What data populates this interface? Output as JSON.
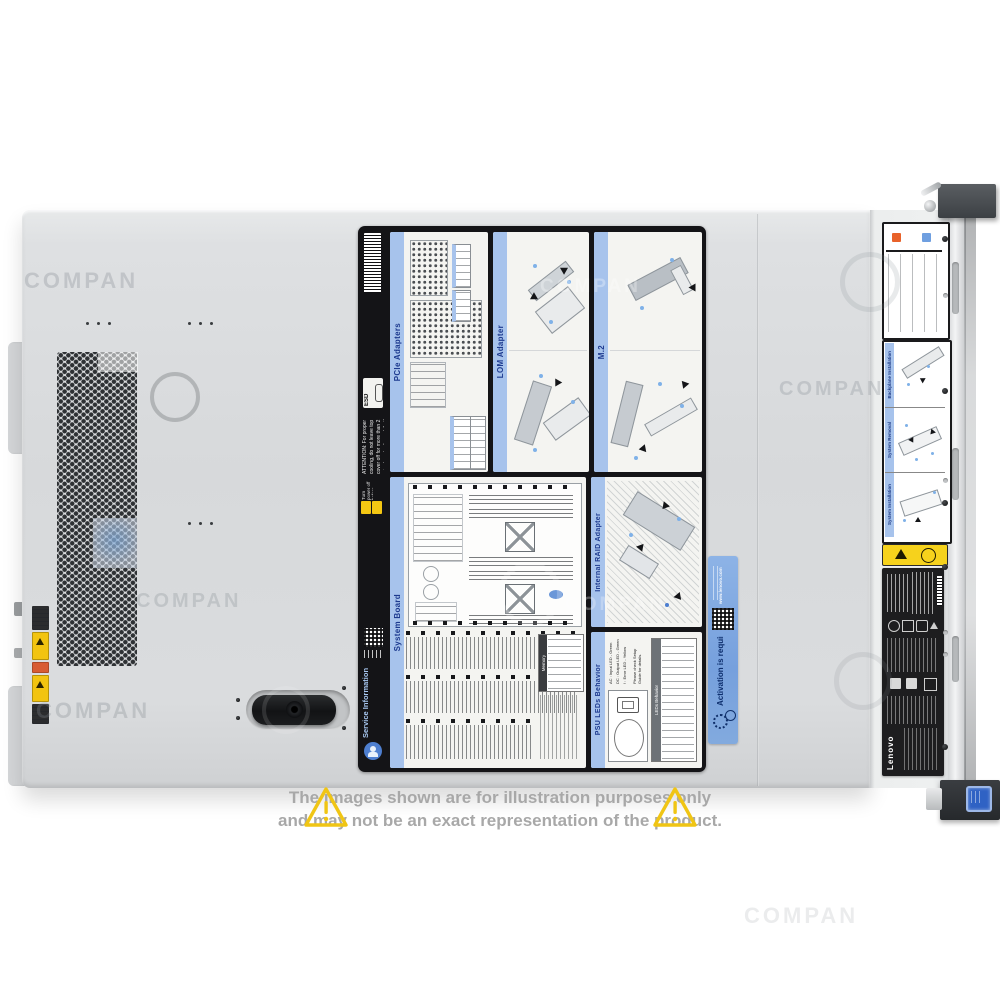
{
  "watermark": {
    "text": "COMPAN"
  },
  "disclaimer": {
    "line1": "The images shown are for illustration purposes only",
    "line2": "and may not be an exact representation of the product."
  },
  "icons": {
    "exclaim": "!"
  },
  "service_label": {
    "esd": "ESD",
    "attention": "ATTENTION: For proper cooling, do not leave top cover off for more than 2 minutes at a time while the system is running.",
    "power_off_note": "Turn power off before removing any non-hot swappable part.",
    "service_line1": "Service",
    "service_line2": "Information",
    "panels": {
      "pcie": {
        "title": "PCIe Adapters"
      },
      "lom": {
        "title": "LOM Adapter"
      },
      "m2": {
        "title": "M.2"
      },
      "system_board": {
        "title": "System Board",
        "memory_title": "Memory"
      },
      "raid": {
        "title": "Internal RAID Adapter"
      },
      "psu": {
        "title": "PSU LEDs Behavior",
        "legend": [
          "AC : Input LED - Green",
          "DC : Output LED - Green",
          "! : Error LED - Yellow"
        ],
        "note": "Please check Setup Guide for details.",
        "table_title": "LEDs Behavior"
      }
    }
  },
  "activation_sticker": {
    "title": "Activation is required",
    "url": "www.lenovo.com"
  },
  "front_panel": {
    "sections": [
      {
        "title": "Backplane Installation"
      },
      {
        "title": "System Removal"
      },
      {
        "title": "System Installation"
      }
    ]
  },
  "regulatory": {
    "brand": "Lenovo"
  }
}
